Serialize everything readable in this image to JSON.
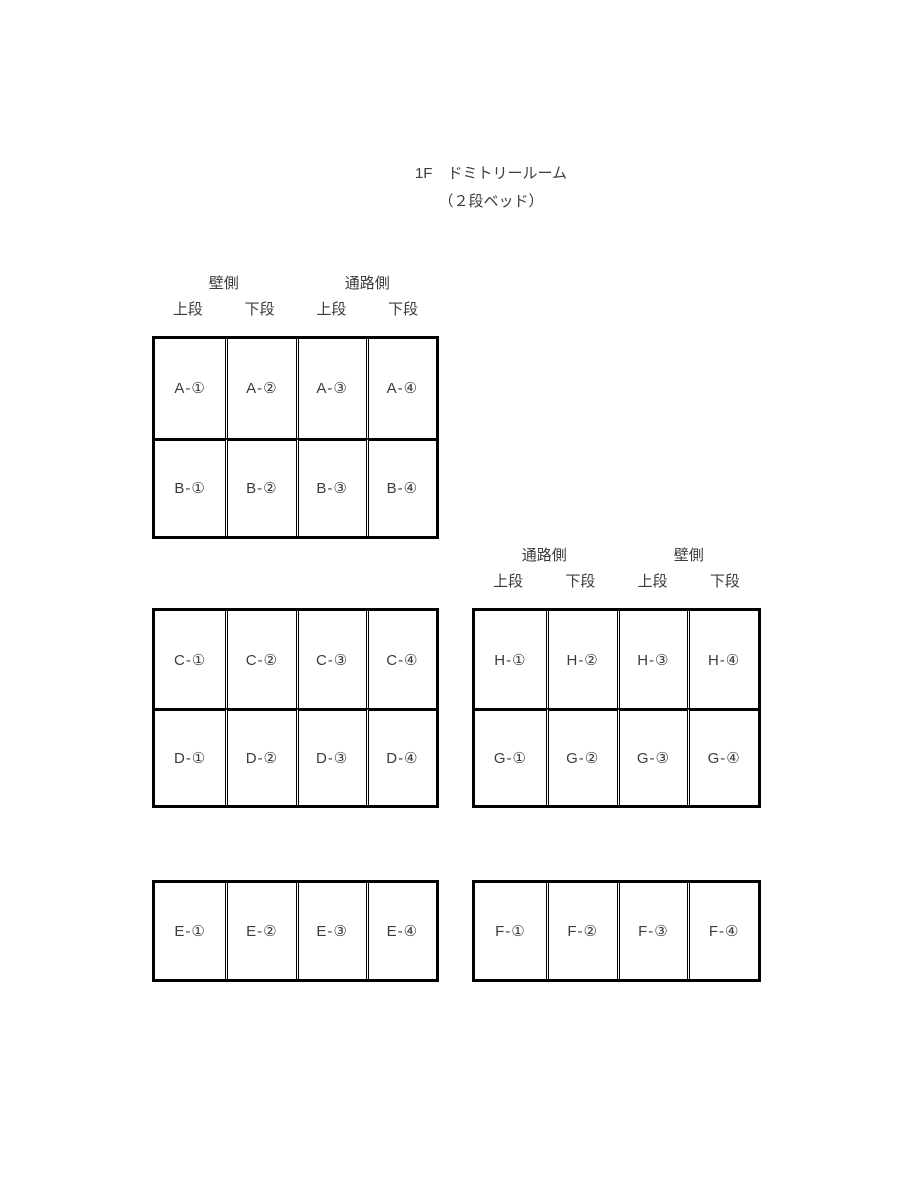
{
  "page": {
    "title_line1": "1F　ドミトリールーム",
    "title_line2": "（２段ベッド）"
  },
  "headers": {
    "left": {
      "groups": [
        "壁側",
        "通路側"
      ],
      "tiers": [
        "上段",
        "下段",
        "上段",
        "下段"
      ]
    },
    "right": {
      "groups": [
        "通路側",
        "壁側"
      ],
      "tiers": [
        "上段",
        "下段",
        "上段",
        "下段"
      ]
    }
  },
  "grids": {
    "ab": {
      "rows": [
        [
          "A-①",
          "A-②",
          "A-③",
          "A-④"
        ],
        [
          "B-①",
          "B-②",
          "B-③",
          "B-④"
        ]
      ]
    },
    "cd": {
      "rows": [
        [
          "C-①",
          "C-②",
          "C-③",
          "C-④"
        ],
        [
          "D-①",
          "D-②",
          "D-③",
          "D-④"
        ]
      ]
    },
    "hg": {
      "rows": [
        [
          "H-①",
          "H-②",
          "H-③",
          "H-④"
        ],
        [
          "G-①",
          "G-②",
          "G-③",
          "G-④"
        ]
      ]
    },
    "e": {
      "rows": [
        [
          "E-①",
          "E-②",
          "E-③",
          "E-④"
        ]
      ]
    },
    "f": {
      "rows": [
        [
          "F-①",
          "F-②",
          "F-③",
          "F-④"
        ]
      ]
    }
  },
  "colors": {
    "background": "#ffffff",
    "border": "#000000",
    "text": "#3c3c3c"
  }
}
